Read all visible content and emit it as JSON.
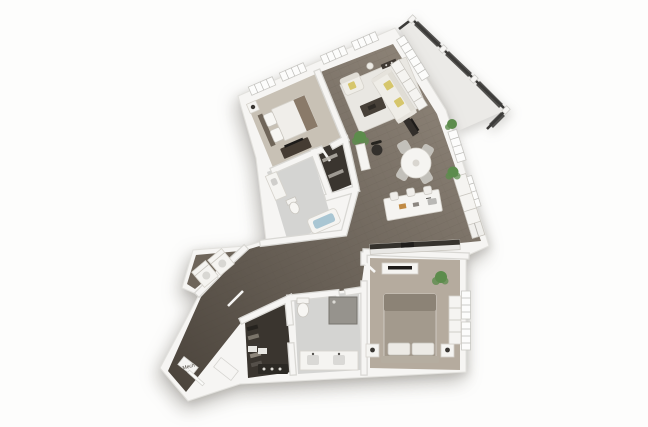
{
  "labels": {
    "mech": "Mech"
  },
  "palette": {
    "wall": "#f6f5f3",
    "wall_edge": "#d9d8d4",
    "window_white": "#fcfcfb",
    "wood_light": "#90867a",
    "wood_dark": "#4a433b",
    "carpet_bedroom2": "#c8c1b5",
    "carpet_master": "#b5ab9e",
    "tile_bath": "#d4d4d2",
    "closet_floor": "#3a352f",
    "wd_floor": "#6e655a",
    "balcony_floor": "#ebeae7",
    "rug": "#e9e7e2",
    "sofa": "#efede7",
    "pillow_yellow": "#d6c66b",
    "bed_master": "#a39a8d",
    "bed_white": "#f0eeea",
    "railing": "#3c3b39",
    "plant": "#5c8c4c",
    "water": "#a9c6d3",
    "chair": "#c2c0ba",
    "island": "#f5f4f1",
    "counter_dark": "#35322d",
    "dark_wood": "#453c33",
    "tv": "#1d1b19",
    "shower": "#96938d"
  }
}
